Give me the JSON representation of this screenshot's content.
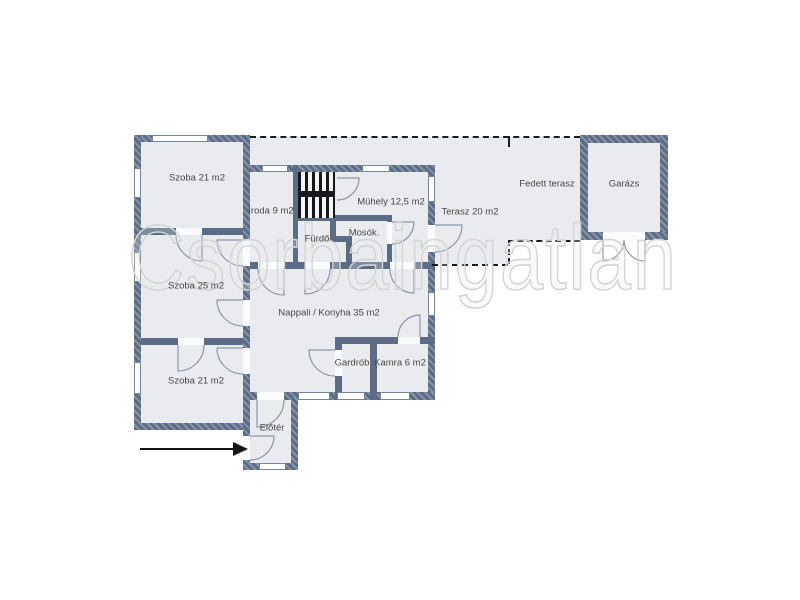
{
  "watermark": "Csorbaingatlan",
  "rooms": {
    "szoba21_top": {
      "label": "Szoba 21 m2"
    },
    "iroda": {
      "label": "Iroda 9 m2"
    },
    "muhely": {
      "label": "Mühely 12,5 m2"
    },
    "terasz": {
      "label": "Terasz 20 m2"
    },
    "fedett_terasz": {
      "label": "Fedett terasz"
    },
    "garazs": {
      "label": "Garázs"
    },
    "furdo": {
      "label": "Fürdő"
    },
    "mosok": {
      "label": "Mosók."
    },
    "szoba25": {
      "label": "Szoba 25 m2"
    },
    "nappali": {
      "label": "Nappali / Konyha 35 m2"
    },
    "gardrob": {
      "label": "Gardrób"
    },
    "kamra": {
      "label": "Kamra 6 m2"
    },
    "szoba21_bottom": {
      "label": "Szoba 21 m2"
    },
    "eloter": {
      "label": "Előtér"
    }
  },
  "colors": {
    "wall": "#5c6c86",
    "wall_light": "#8693a8",
    "room_fill": "#e9ebee",
    "label": "#474747",
    "dash": "#1c1c1c",
    "arc": "#8d97a8",
    "watermark": "#d4d4d4"
  }
}
